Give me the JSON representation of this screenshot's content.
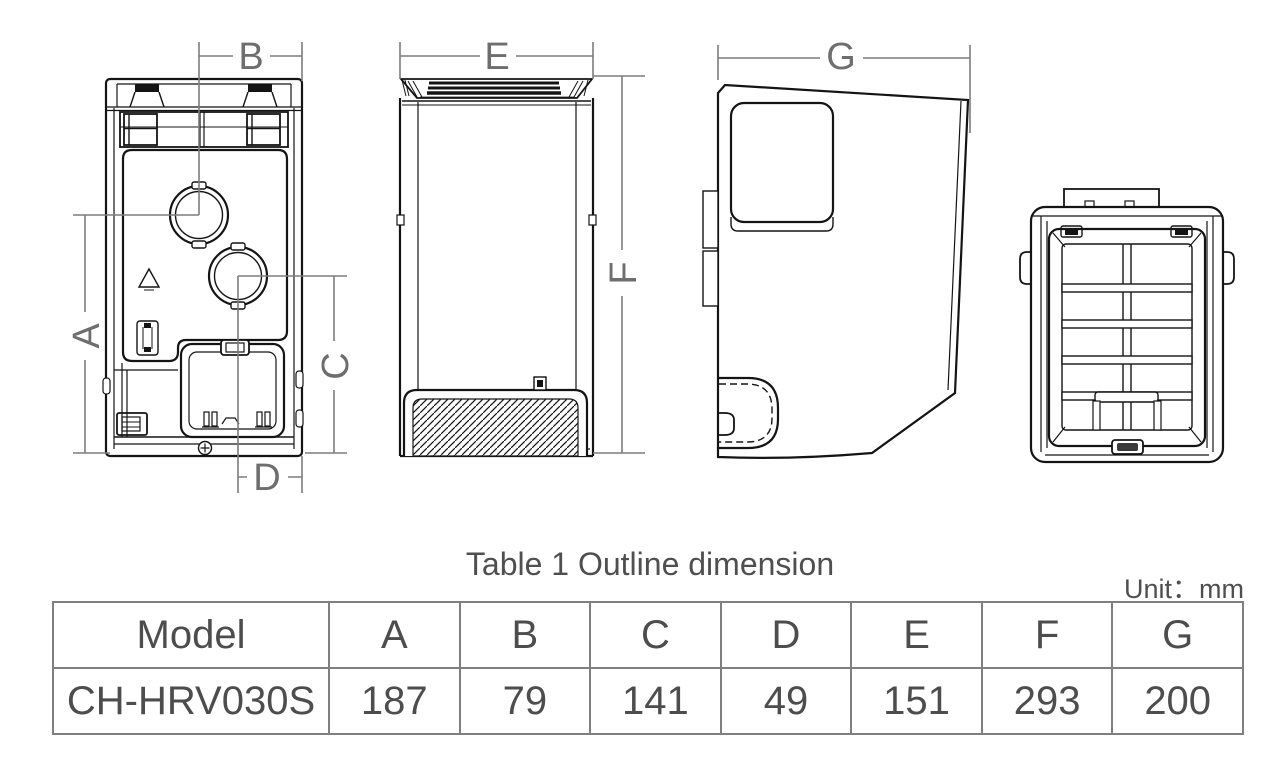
{
  "figure": {
    "dims": {
      "A": "A",
      "B": "B",
      "C": "C",
      "D": "D",
      "E": "E",
      "F": "F",
      "G": "G"
    }
  },
  "table": {
    "title": "Table 1 Outline dimension",
    "unit": "Unit：mm",
    "headers": [
      "Model",
      "A",
      "B",
      "C",
      "D",
      "E",
      "F",
      "G"
    ],
    "rows": [
      [
        "CH-HRV030S",
        "187",
        "79",
        "141",
        "49",
        "151",
        "293",
        "200"
      ]
    ]
  },
  "colors": {
    "drawing_line": "#141414",
    "dimension_line": "#7d7d7d",
    "table_text": "#4d4d4d",
    "table_border": "#7f7f7f"
  }
}
